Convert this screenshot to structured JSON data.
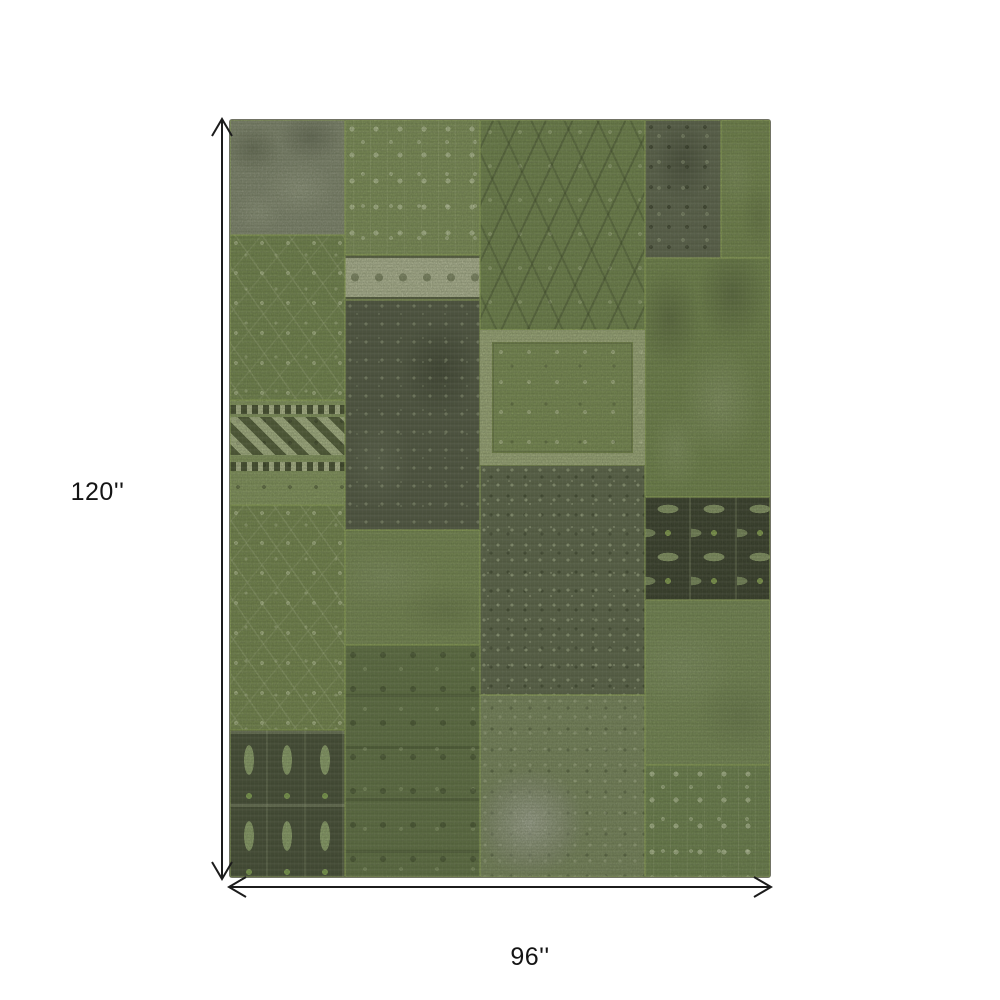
{
  "diagram": {
    "height_label": "120''",
    "width_label": "96''",
    "arrow_color": "#1c1c1c",
    "label_color": "#141414",
    "background_color": "#ffffff"
  },
  "rug": {
    "description": "green patchwork area rug",
    "seam_color": "#96ac62",
    "edge_color": "#3a3e2c",
    "palette": {
      "base_green": "#7a8c55",
      "bright_seam_green": "#9eb46a",
      "gray": "#888c7a",
      "dark_gray_green": "#4d5143",
      "cream": "#bfc3a4",
      "near_black": "#2e3226"
    },
    "patches": [
      {
        "name": "left-top-gray",
        "x": 0,
        "y": 0,
        "w": 21.3,
        "h": 15.2,
        "base": "#888c7a",
        "pattern": "mottled"
      },
      {
        "name": "left-floral-upper",
        "x": 0,
        "y": 15.2,
        "w": 21.3,
        "h": 21.8,
        "base": "#75884f",
        "pattern": "floral"
      },
      {
        "name": "left-kilim-band",
        "x": 0,
        "y": 37.0,
        "w": 21.3,
        "h": 13.9,
        "base": "#8a9c62",
        "pattern": "kilim"
      },
      {
        "name": "left-floral-vines",
        "x": 0,
        "y": 50.9,
        "w": 21.3,
        "h": 29.7,
        "base": "#77894f",
        "pattern": "floral"
      },
      {
        "name": "left-turkmen",
        "x": 0,
        "y": 80.6,
        "w": 21.3,
        "h": 19.4,
        "base": "#3e4433",
        "pattern": "turkmen"
      },
      {
        "name": "mid-left-floral-light",
        "x": 21.3,
        "y": 0,
        "w": 25.0,
        "h": 17.8,
        "base": "#83955c",
        "pattern": "floral-light"
      },
      {
        "name": "mid-left-cream-band",
        "x": 21.3,
        "y": 17.8,
        "w": 25.0,
        "h": 6.0,
        "base": "#bfc3a4",
        "pattern": "band-cream"
      },
      {
        "name": "mid-left-dark-gray",
        "x": 21.3,
        "y": 23.8,
        "w": 25.0,
        "h": 30.4,
        "base": "#4d5143",
        "pattern": "dark-mottled"
      },
      {
        "name": "mid-left-plain-green",
        "x": 21.3,
        "y": 54.2,
        "w": 25.0,
        "h": 15.2,
        "base": "#7a8c55",
        "pattern": "plain"
      },
      {
        "name": "mid-left-dense-floral",
        "x": 21.3,
        "y": 69.4,
        "w": 25.0,
        "h": 30.6,
        "base": "#5f7044",
        "pattern": "dense-floral"
      },
      {
        "name": "mid-right-swirl",
        "x": 46.3,
        "y": 0,
        "w": 30.6,
        "h": 27.7,
        "base": "#72864e",
        "pattern": "swirl"
      },
      {
        "name": "mid-right-framed-floral",
        "x": 46.3,
        "y": 27.7,
        "w": 30.6,
        "h": 17.9,
        "base": "#7e9156",
        "pattern": "frame"
      },
      {
        "name": "mid-right-speckled-dark",
        "x": 46.3,
        "y": 45.6,
        "w": 30.6,
        "h": 30.4,
        "base": "#5a614b",
        "pattern": "speckled"
      },
      {
        "name": "mid-right-gray-blob",
        "x": 46.3,
        "y": 76.0,
        "w": 30.6,
        "h": 24.0,
        "base": "#7d8a62",
        "pattern": "blob"
      },
      {
        "name": "right-top-dark-ornate",
        "x": 76.9,
        "y": 0,
        "w": 14.0,
        "h": 18.2,
        "base": "#5c6150",
        "pattern": "dark-ornate"
      },
      {
        "name": "right-top-green",
        "x": 90.9,
        "y": 0,
        "w": 9.1,
        "h": 18.2,
        "base": "#76894f",
        "pattern": "plain"
      },
      {
        "name": "right-mottled-green",
        "x": 76.9,
        "y": 18.2,
        "w": 23.1,
        "h": 31.6,
        "base": "#74884e",
        "pattern": "mottled"
      },
      {
        "name": "right-black-geometric",
        "x": 76.9,
        "y": 49.8,
        "w": 23.1,
        "h": 13.6,
        "base": "#2e3226",
        "pattern": "geometric"
      },
      {
        "name": "right-plain-green",
        "x": 76.9,
        "y": 63.4,
        "w": 23.1,
        "h": 21.8,
        "base": "#7a8d58",
        "pattern": "plain"
      },
      {
        "name": "right-bottom-floral",
        "x": 76.9,
        "y": 85.2,
        "w": 23.1,
        "h": 14.8,
        "base": "#6f8450",
        "pattern": "floral-light"
      }
    ]
  }
}
